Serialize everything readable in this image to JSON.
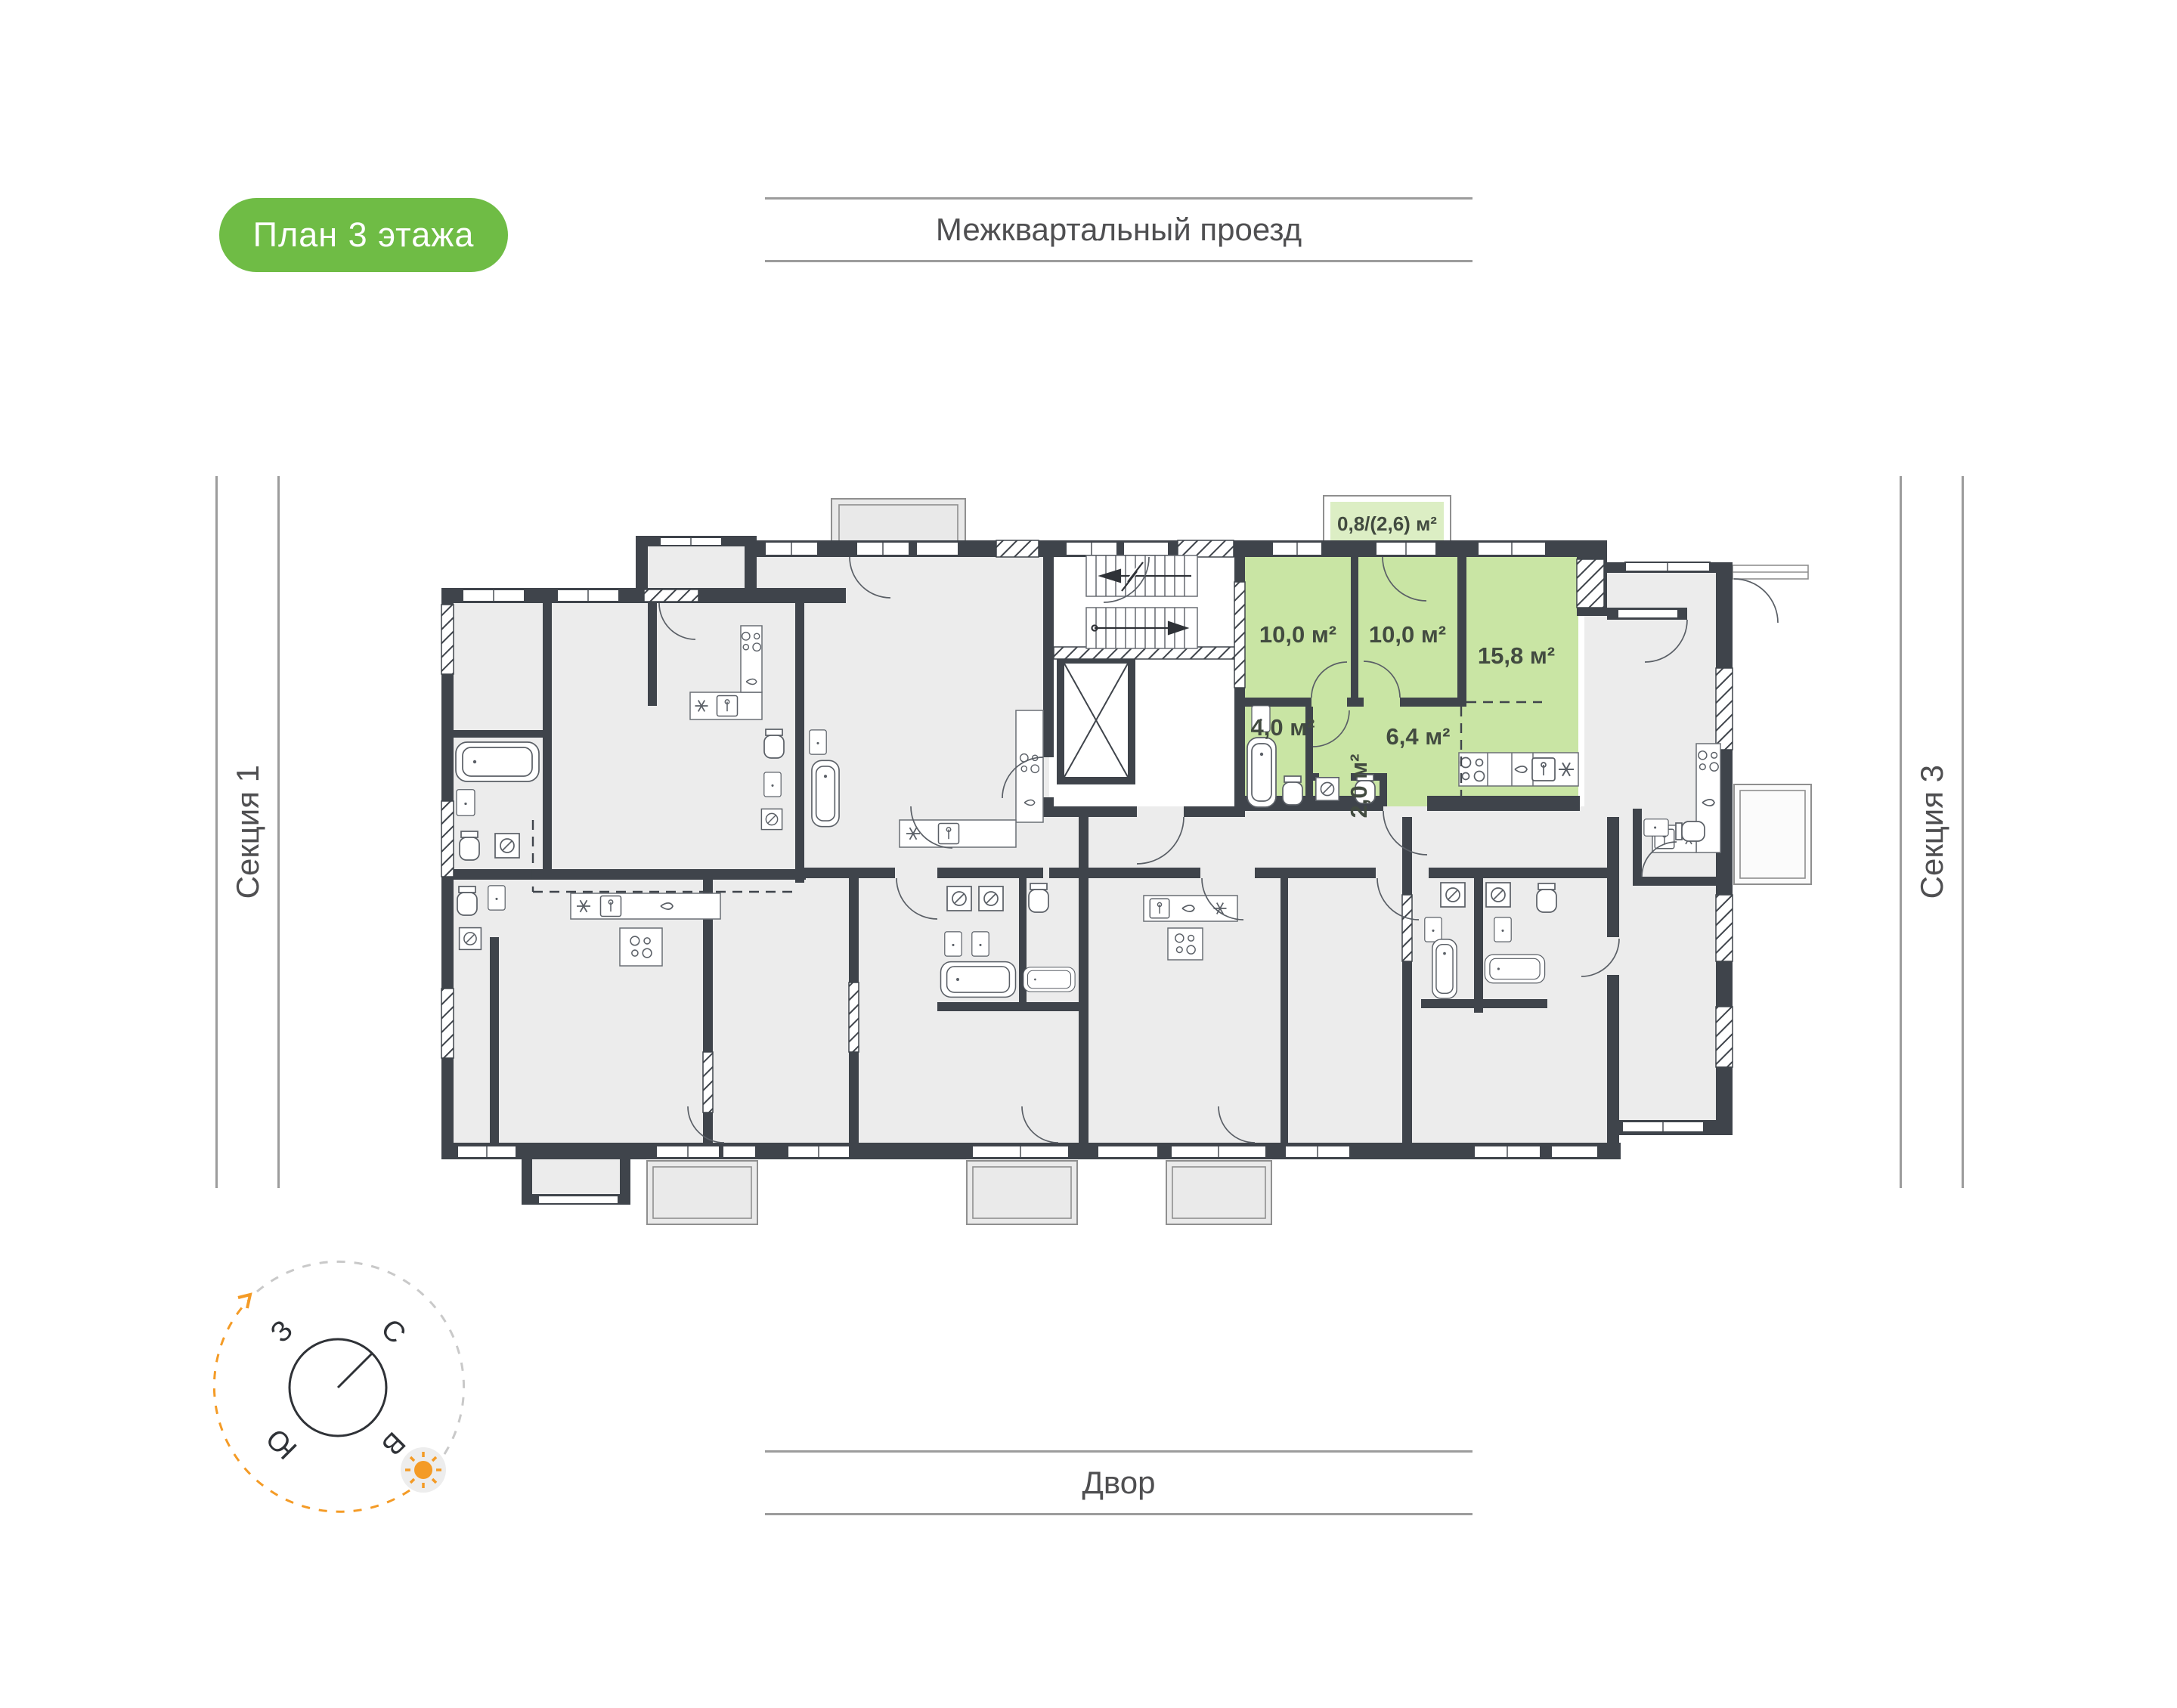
{
  "badge": {
    "label": "План 3 этажа",
    "background": "#6FBC45"
  },
  "surroundings": {
    "top_label": "Межквартальный проезд",
    "bottom_label": "Двор",
    "left_label": "Секция 1",
    "right_label": "Секция 3"
  },
  "compass": {
    "north": "С",
    "east": "В",
    "south": "Ю",
    "west": "З",
    "accent": "#F49B26"
  },
  "plan": {
    "highlight_fill": "#C9E5A4",
    "balcony_fill": "#DCEEC4",
    "room_fill": "#ECECEC",
    "wall_color": "#3F444B",
    "apartment": {
      "balcony_area": "0,8/(2,6) м²",
      "rooms": [
        {
          "name": "bedroom-1",
          "area": "10,0 м²"
        },
        {
          "name": "bedroom-2",
          "area": "10,0 м²"
        },
        {
          "name": "kitchen-living",
          "area": "15,8 м²"
        },
        {
          "name": "bathroom",
          "area": "4,0 м²"
        },
        {
          "name": "wc",
          "area": "2,0 м²"
        },
        {
          "name": "hallway",
          "area": "6,4 м²"
        }
      ]
    },
    "icons": [
      "stove-icon",
      "sink-icon",
      "washer-icon",
      "fridge-icon",
      "bathtub-icon",
      "toilet-icon",
      "elevator-icon",
      "stairs-icon",
      "sun-icon"
    ]
  }
}
